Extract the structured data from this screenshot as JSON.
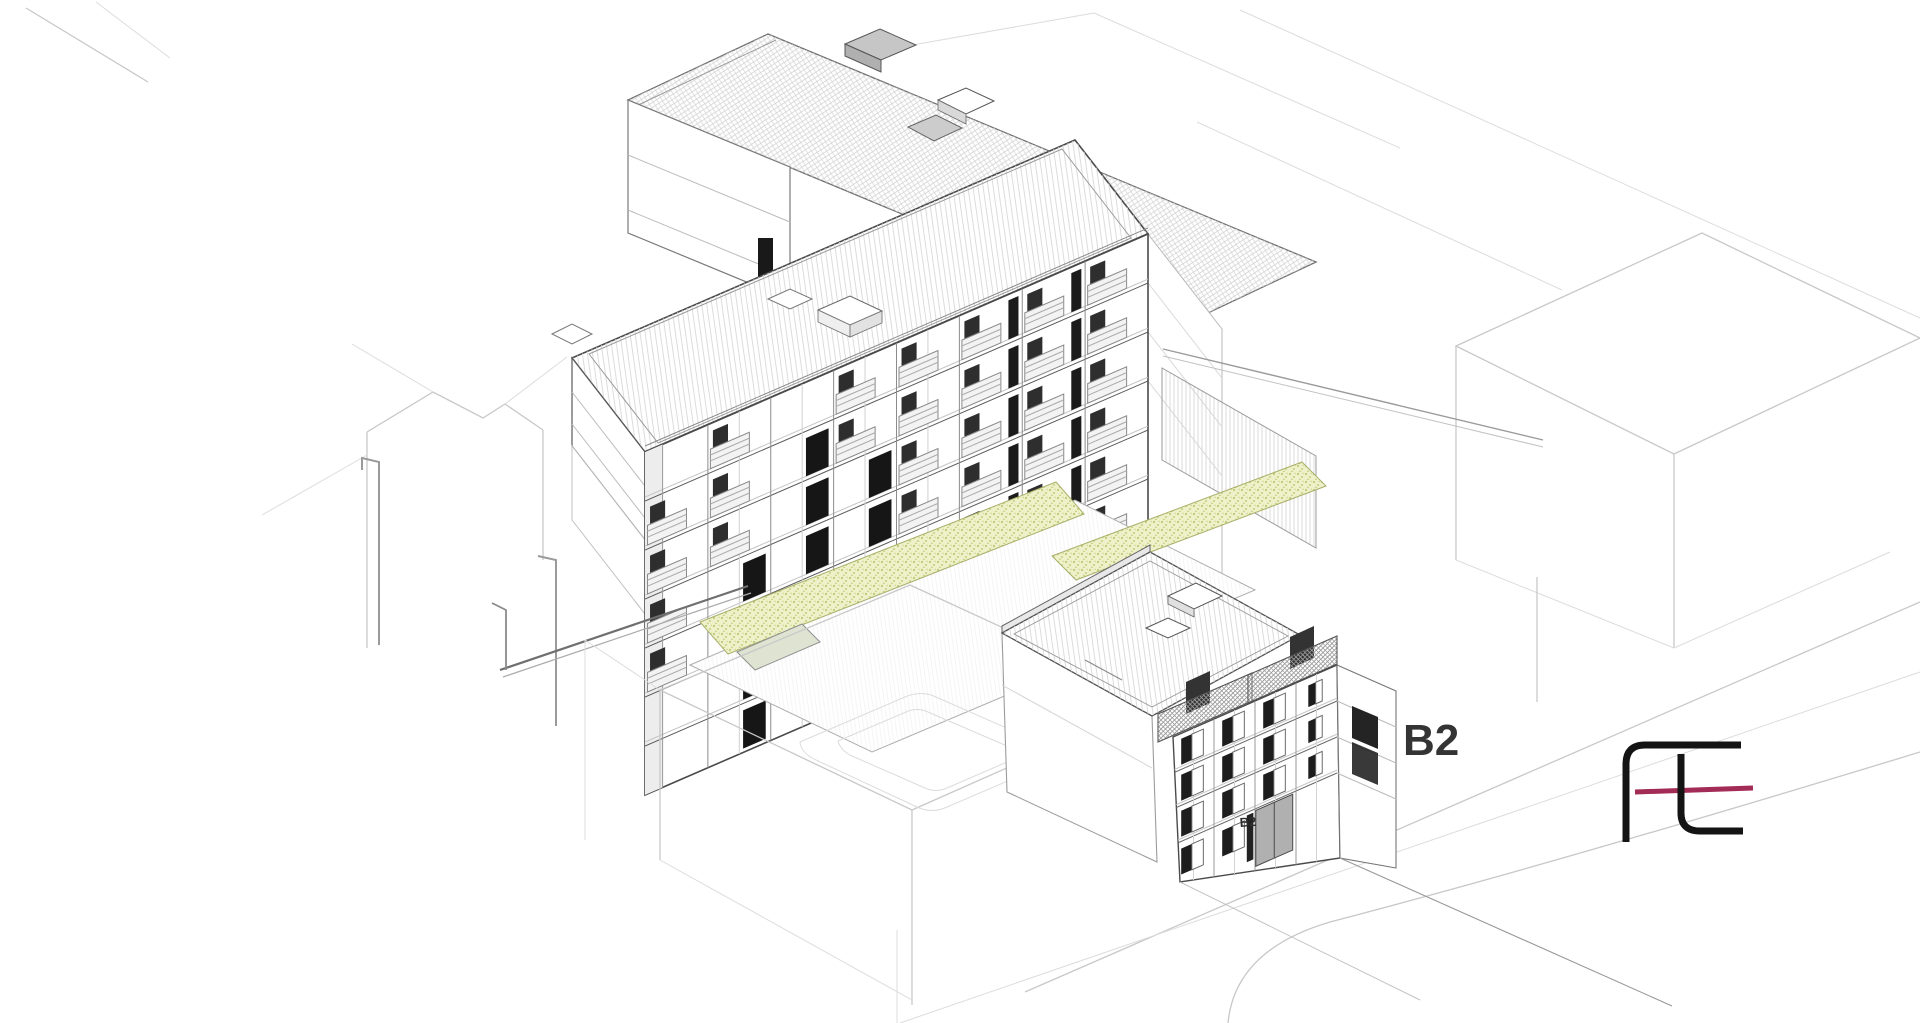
{
  "scene": {
    "type": "axonometric architectural line drawing",
    "labels": {
      "building_large": "B2",
      "building_entrance": "B2"
    },
    "colors": {
      "background": "#ffffff",
      "outline_dark": "#4a4a4a",
      "outline_mid": "#8c8c8c",
      "outline_context": "#c8c8c8",
      "glazing_black": "#161616",
      "roof_box_gray": "#c6c6c6",
      "planting_fill": "#eef0c9",
      "planting_dot": "#bccb72",
      "deck_green": "#dfe4d2"
    }
  },
  "logo": {
    "name": "fl-monogram",
    "color_black": "#141414",
    "color_red": "#a22c55"
  }
}
